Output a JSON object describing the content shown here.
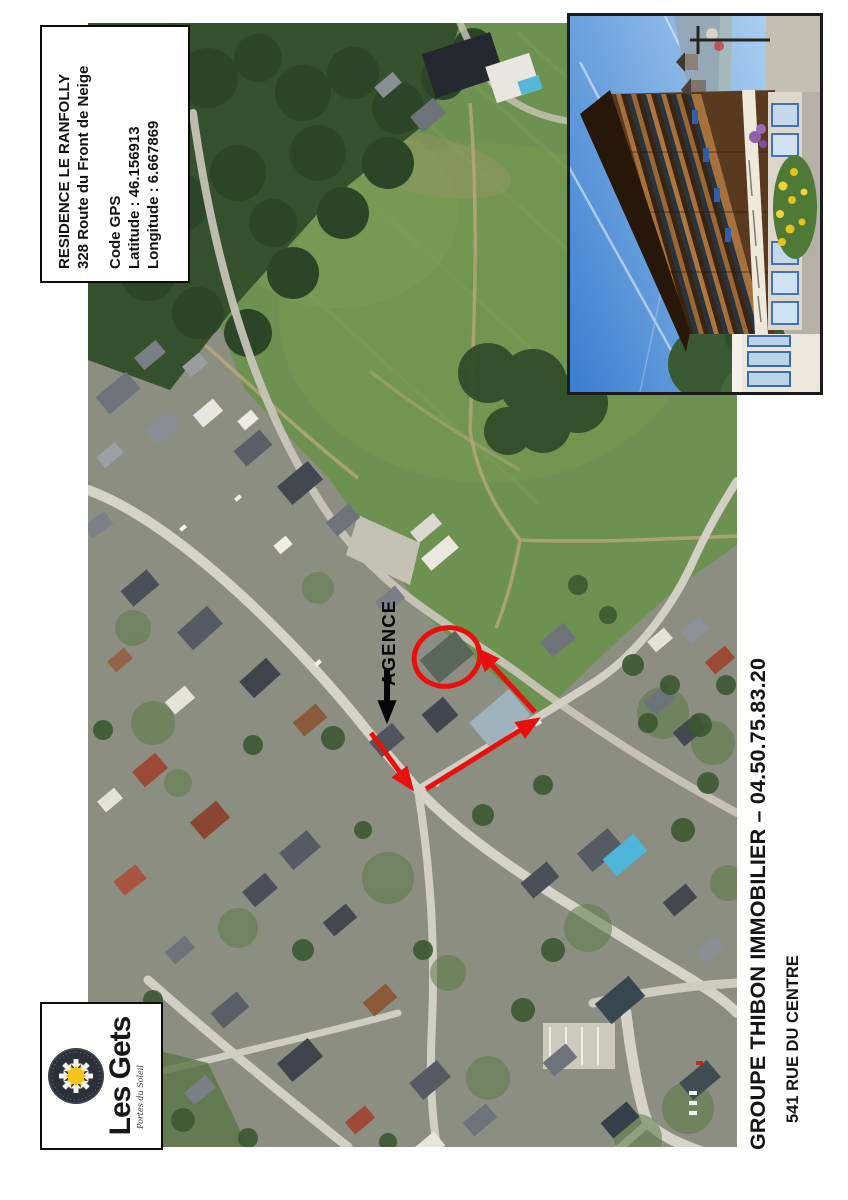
{
  "info_box": {
    "title": "RESIDENCE LE RANFOLLY",
    "address": "328 Route du Front de Neige",
    "gps_heading": "Code GPS",
    "latitude": "Latitude : 46.156913",
    "longitude": "Longitude : 6.667869"
  },
  "map": {
    "agence_label": "AGENCE",
    "annotation_color": "#e8100c",
    "agence_arrow_color": "#050505"
  },
  "logo": {
    "name": "Les Gets",
    "tagline": "Portes du Soleil"
  },
  "contact": {
    "line1": "GROUPE THIBON IMMOBILIER – 04.50.75.83.20",
    "line2": "541 RUE DU CENTRE"
  }
}
